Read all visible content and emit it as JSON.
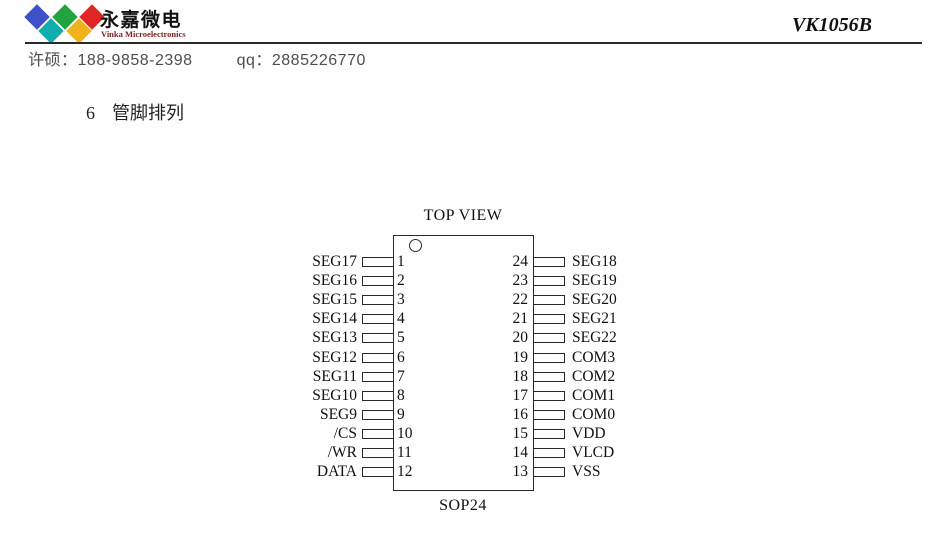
{
  "colors": {
    "ink": "#1a1a1a",
    "contact_text": "#4f4f4f",
    "brand_en_text": "#7a2424",
    "rule": "#2a2a2a"
  },
  "header": {
    "logo": {
      "brand_cn": "永嘉微电",
      "brand_en": "Vinka Microelectronics",
      "diamonds": [
        {
          "name": "blue",
          "color": "#4050c8"
        },
        {
          "name": "green",
          "color": "#21a43f"
        },
        {
          "name": "red",
          "color": "#e02525"
        },
        {
          "name": "cyan",
          "color": "#11adad"
        },
        {
          "name": "yellow",
          "color": "#f0b41a"
        }
      ]
    },
    "part_number": "VK1056B",
    "contact": {
      "name_label": "许硕：",
      "phone": "188-9858-2398",
      "qq_label": "qq：",
      "qq_number": "2885226770"
    }
  },
  "section": {
    "number": "6",
    "title": "管脚排列"
  },
  "diagram": {
    "top_label": "TOP VIEW",
    "package_label": "SOP24",
    "pins": [
      {
        "left_label": "SEG17",
        "left_num": "1",
        "right_num": "24",
        "right_label": "SEG18"
      },
      {
        "left_label": "SEG16",
        "left_num": "2",
        "right_num": "23",
        "right_label": "SEG19"
      },
      {
        "left_label": "SEG15",
        "left_num": "3",
        "right_num": "22",
        "right_label": "SEG20"
      },
      {
        "left_label": "SEG14",
        "left_num": "4",
        "right_num": "21",
        "right_label": "SEG21"
      },
      {
        "left_label": "SEG13",
        "left_num": "5",
        "right_num": "20",
        "right_label": "SEG22"
      },
      {
        "left_label": "SEG12",
        "left_num": "6",
        "right_num": "19",
        "right_label": "COM3"
      },
      {
        "left_label": "SEG11",
        "left_num": "7",
        "right_num": "18",
        "right_label": "COM2"
      },
      {
        "left_label": "SEG10",
        "left_num": "8",
        "right_num": "17",
        "right_label": "COM1"
      },
      {
        "left_label": "SEG9",
        "left_num": "9",
        "right_num": "16",
        "right_label": "COM0"
      },
      {
        "left_label": "/CS",
        "left_num": "10",
        "right_num": "15",
        "right_label": "VDD"
      },
      {
        "left_label": "/WR",
        "left_num": "11",
        "right_num": "14",
        "right_label": "VLCD"
      },
      {
        "left_label": "DATA",
        "left_num": "12",
        "right_num": "13",
        "right_label": "VSS"
      }
    ]
  }
}
